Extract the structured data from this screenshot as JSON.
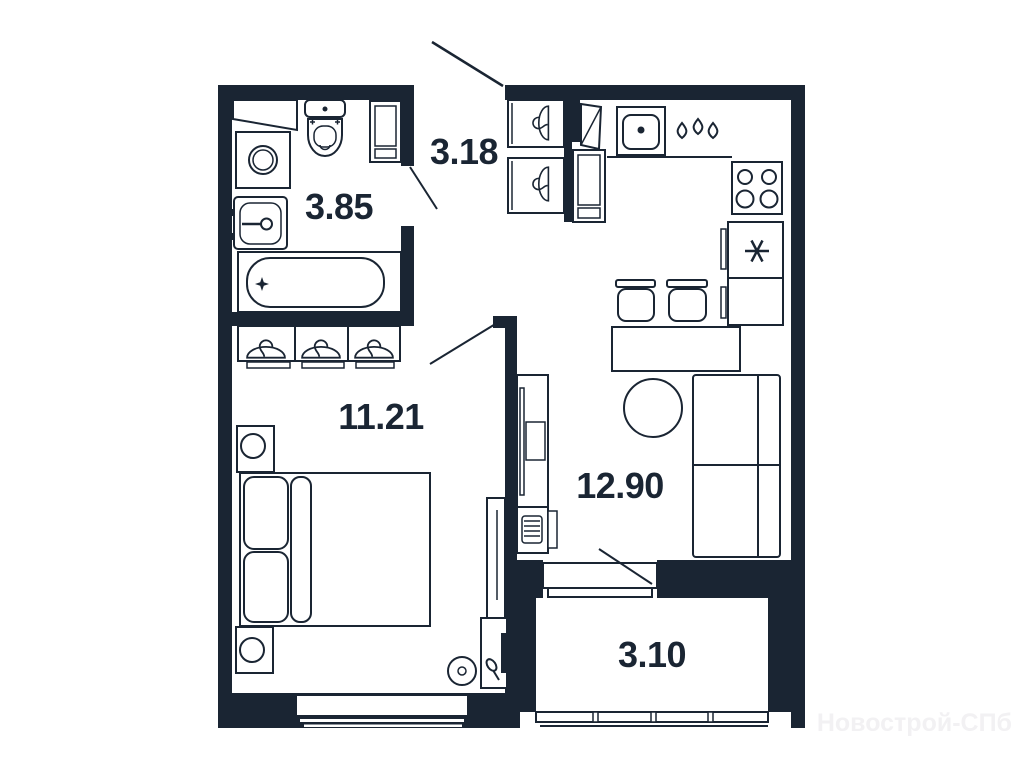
{
  "floor_plan": {
    "watermark": "Новострой-СПб",
    "rooms": [
      {
        "id": "bathroom",
        "area": "3.85"
      },
      {
        "id": "hallway",
        "area": "3.18"
      },
      {
        "id": "bedroom",
        "area": "11.21"
      },
      {
        "id": "kitchen-living-room",
        "area": "12.90"
      },
      {
        "id": "balcony",
        "area": "3.10"
      }
    ],
    "colors": {
      "ink": "#1a2533",
      "background": "#ffffff",
      "watermark": "#f2f1f3"
    },
    "icons": [
      "washing-machine-icon",
      "toilet-icon",
      "wash-basin-icon",
      "bathtub-icon",
      "storage-cabinet-icon",
      "coat-hanger-icon",
      "door-swing-icon",
      "kitchen-sink-icon",
      "water-drops-icon",
      "stove-icon",
      "fridge-snowflake-icon",
      "dining-stool-icon",
      "dining-table-icon",
      "round-table-icon",
      "sofa-icon",
      "tv-stand-icon",
      "radiator-icon",
      "wardrobe-icon",
      "bed-icon",
      "nightstand-lamp-icon",
      "pouf-icon",
      "desk-lamp-icon",
      "window-icon",
      "balcony-glazing-icon"
    ]
  }
}
